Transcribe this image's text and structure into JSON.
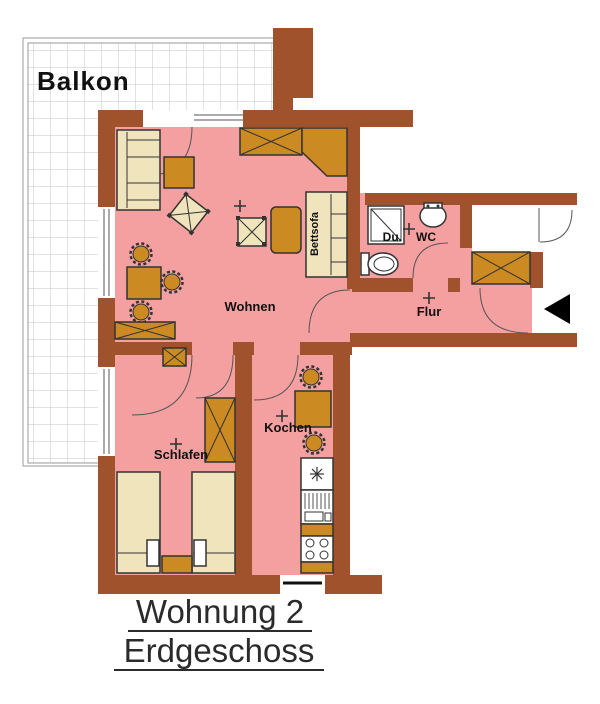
{
  "title": {
    "line1": "Wohnung 2",
    "line2": "Erdgeschoss"
  },
  "rooms": {
    "balcony": "Balkon",
    "living": "Wohnen",
    "bedroom": "Schlafen",
    "kitchen": "Kochen",
    "hallway": "Flur",
    "shower": "Du.",
    "wc": "WC",
    "sofa_bed": "Bettsofa"
  },
  "colors": {
    "wall": "#A0522D",
    "floor": "#F5A0A0",
    "furniture": "#CC8A22",
    "beige": "#F0E4BC",
    "outline": "#333333",
    "door": "#555555",
    "grid": "#C4C4C4",
    "label": "#111111",
    "title": "#2B2B2B",
    "fixture": "#FFFFFF",
    "arrow": "#000000"
  }
}
